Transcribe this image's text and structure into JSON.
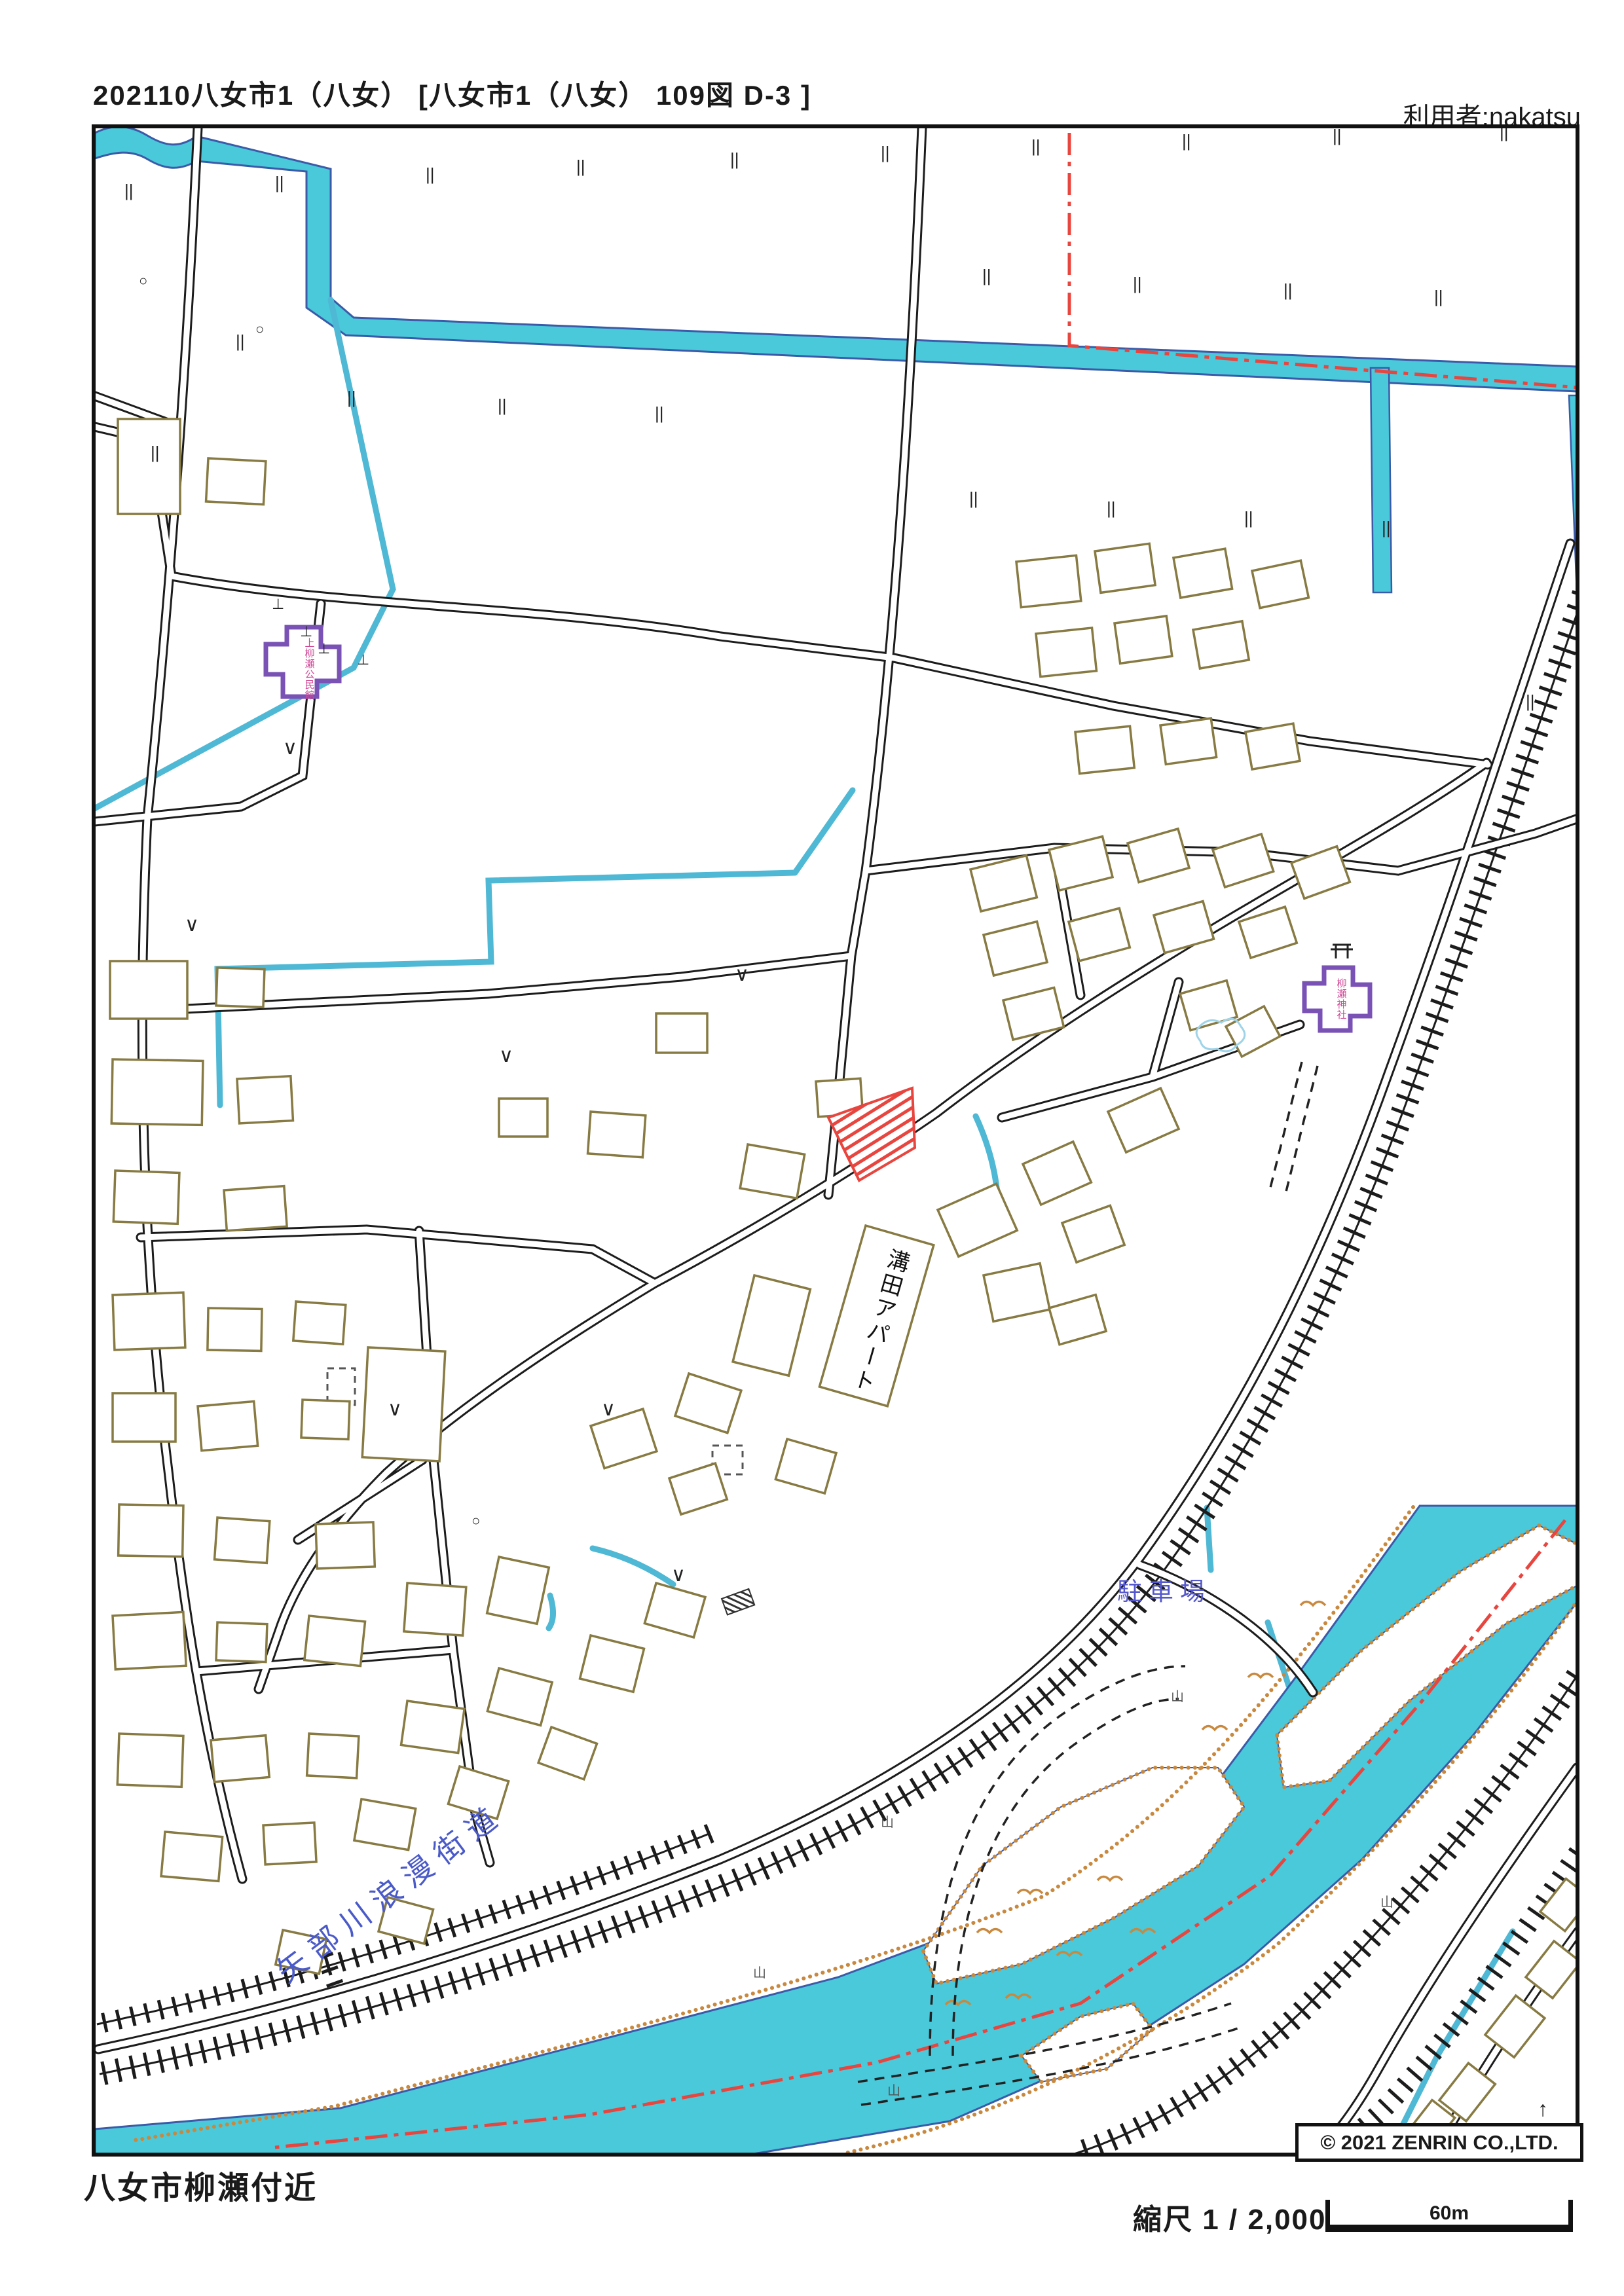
{
  "header": {
    "title": "202110八女市1（八女） [八女市1（八女） 109図 D-3 ]",
    "user_label": "利用者:nakatsu"
  },
  "map": {
    "labels": {
      "apartment": "溝田アパート",
      "parking_lot": "駐車場",
      "scenic_road": "矢部川浪漫街道",
      "community_center": "上柳瀬公民館",
      "shrine": "柳瀬神社",
      "copyright": "© 2021 ZENRIN CO.,LTD."
    },
    "symbols": {
      "paddy_mark": "||",
      "grass_mark": "∨",
      "circle_mark": "○",
      "ground_mark": "⊥",
      "hill_mark": "山",
      "arrow_mark": "↑"
    },
    "colors": {
      "water_fill": "#49c9da",
      "water_edge": "#3b5aa8",
      "building_outline": "#877a42",
      "road_line": "#1c1c1c",
      "boundary_red": "#e8453f",
      "public_building_purple": "#7a52b5",
      "public_text_pink": "#d04898",
      "label_blue": "#4a5ac8",
      "sand_edge_orange": "#c8893f"
    }
  },
  "footer": {
    "area_name": "八女市柳瀬付近",
    "scale_label": "縮尺 1 / 2,000",
    "scale_distance": "60m"
  }
}
